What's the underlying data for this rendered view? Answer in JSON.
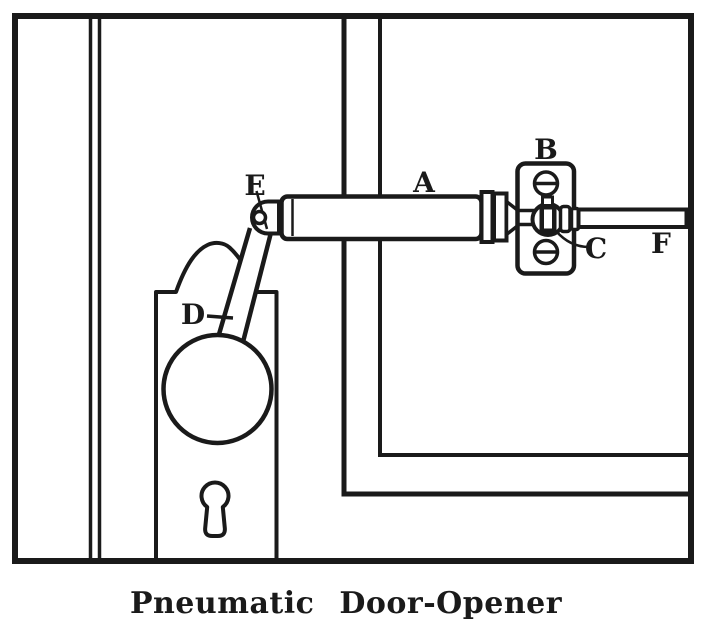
{
  "figure": {
    "caption": "Pneumatic Door-Opener",
    "labels": {
      "a": "A",
      "b": "B",
      "c": "C",
      "d": "D",
      "e": "E",
      "f": "F"
    }
  },
  "colors": {
    "ink": "#1a1a1a",
    "paper": "#ffffff"
  }
}
